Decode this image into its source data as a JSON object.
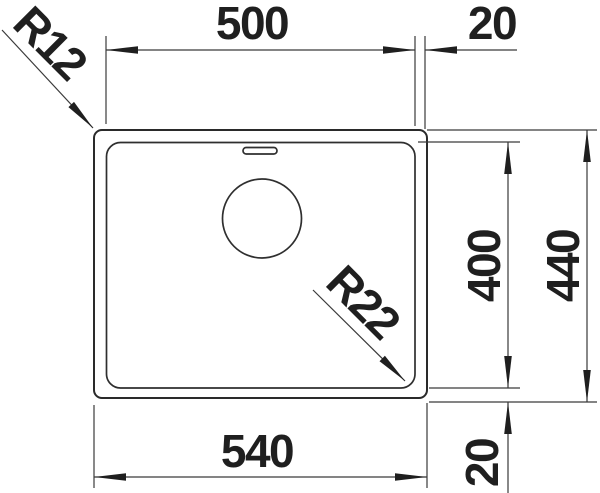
{
  "drawing": {
    "colors": {
      "line": "#2a2a2a",
      "text": "#1f1f1f",
      "background": "#ffffff"
    },
    "dimensions": {
      "bowl_width": "500",
      "right_offset": "20",
      "bowl_depth": "400",
      "overall_depth": "440",
      "overall_width": "540",
      "bottom_offset": "20",
      "outer_corner_radius": "R12",
      "bowl_corner_radius": "R22"
    }
  }
}
